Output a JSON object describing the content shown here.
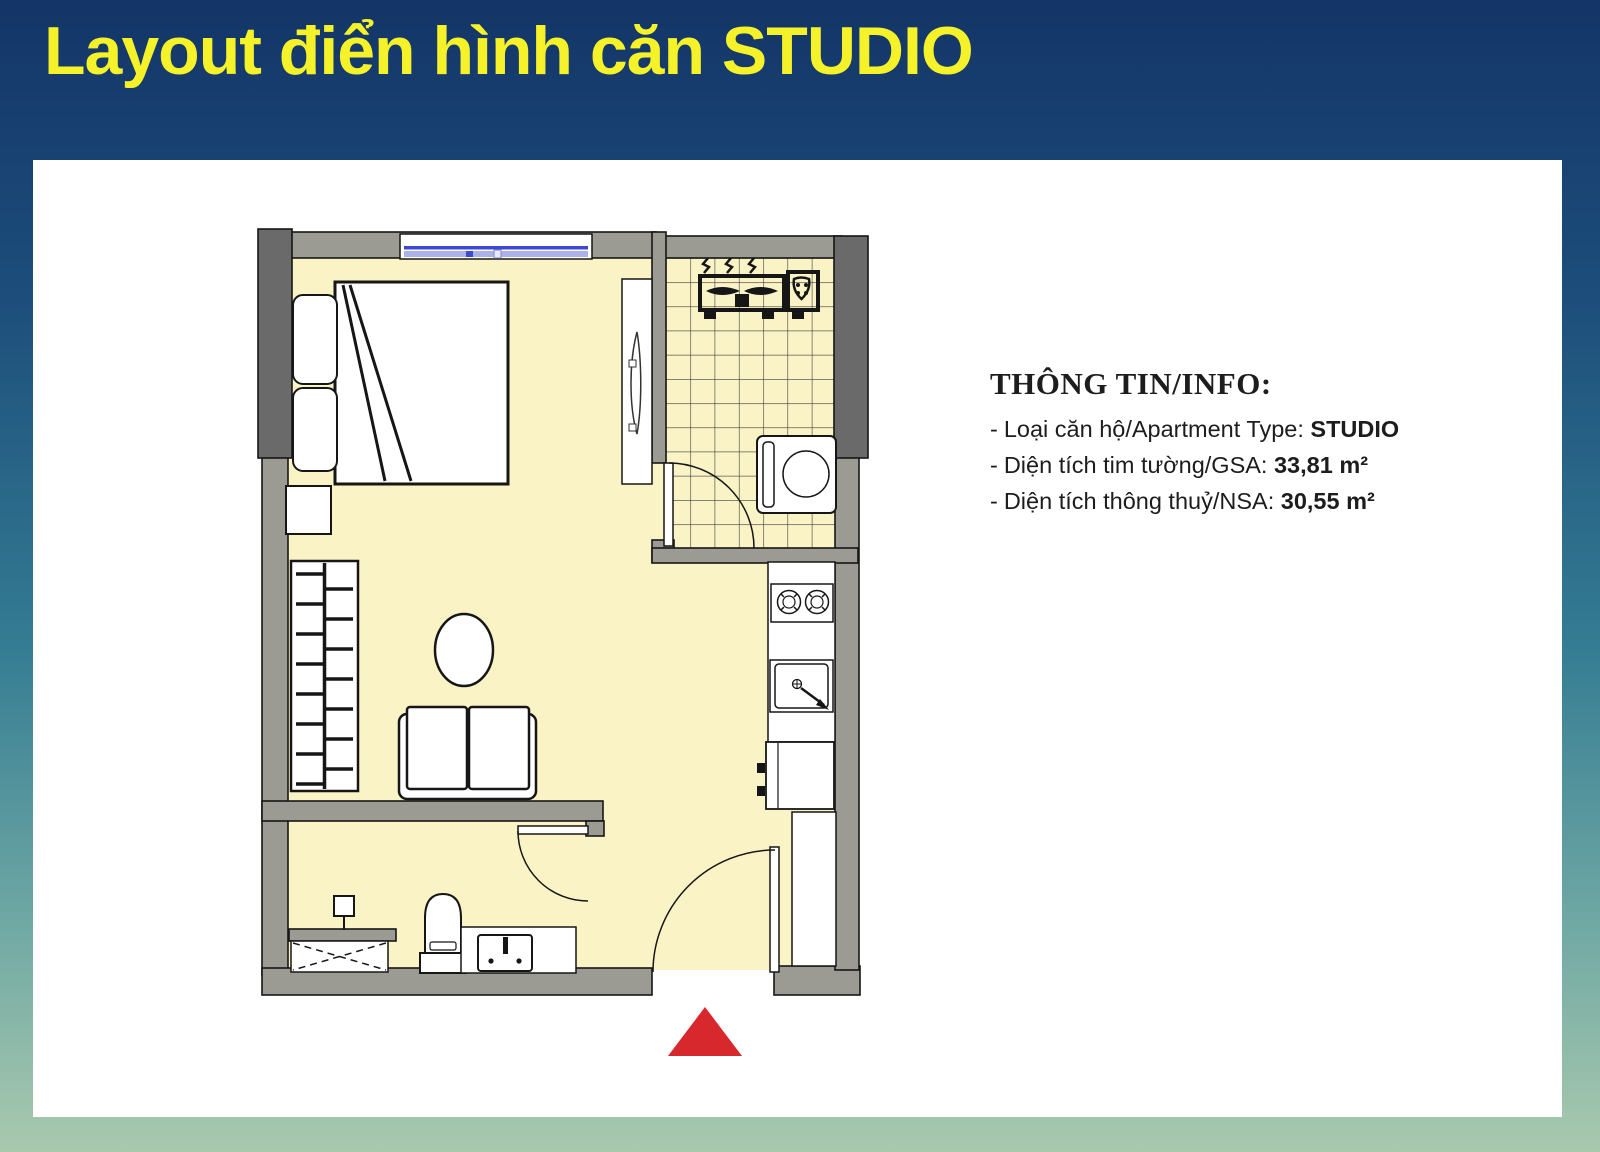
{
  "page": {
    "title": "Layout điển hình căn STUDIO"
  },
  "info": {
    "heading": "THÔNG TIN/INFO:",
    "bullet": "-",
    "items": [
      {
        "label": "Loại căn hộ/Apartment Type: ",
        "value": "STUDIO"
      },
      {
        "label": "Diện tích tim tường/GSA: ",
        "value": "33,81 m²"
      },
      {
        "label": "Diện tích thông thuỷ/NSA: ",
        "value": "30,55 m²"
      }
    ]
  },
  "floor_plan": {
    "elements": [
      "double-bed",
      "pillows",
      "nightstand",
      "window",
      "tv-cabinet",
      "wardrobe-hangers",
      "round-table",
      "sofa",
      "tiled-floor",
      "ac-condenser-unit",
      "washing-machine",
      "laundry-door",
      "stove-2-burner",
      "kitchen-sink",
      "refrigerator",
      "entry-cabinet",
      "bathroom-door",
      "shower-head",
      "shower-tray",
      "toilet",
      "vanity-sink",
      "entrance-door",
      "entrance-arrow"
    ]
  },
  "colors": {
    "bg-top": "#133567",
    "bg-upper": "#1d4e7b",
    "bg-mid": "#347c93",
    "bg-lower": "#6fa8a4",
    "bg-bottom": "#a9c9ae",
    "card-bg": "#ffffff",
    "title-yellow": "#f6f22a",
    "text-dark": "#1d1d1d",
    "wall-gray": "#9b9b93",
    "wall-dark": "#6a6a6a",
    "floor-yellow": "#faf3c6",
    "tile-line": "#3c3c3c",
    "window-blue": "#3f49d0",
    "arrow-red": "#d7282e",
    "line-black": "#161616"
  }
}
